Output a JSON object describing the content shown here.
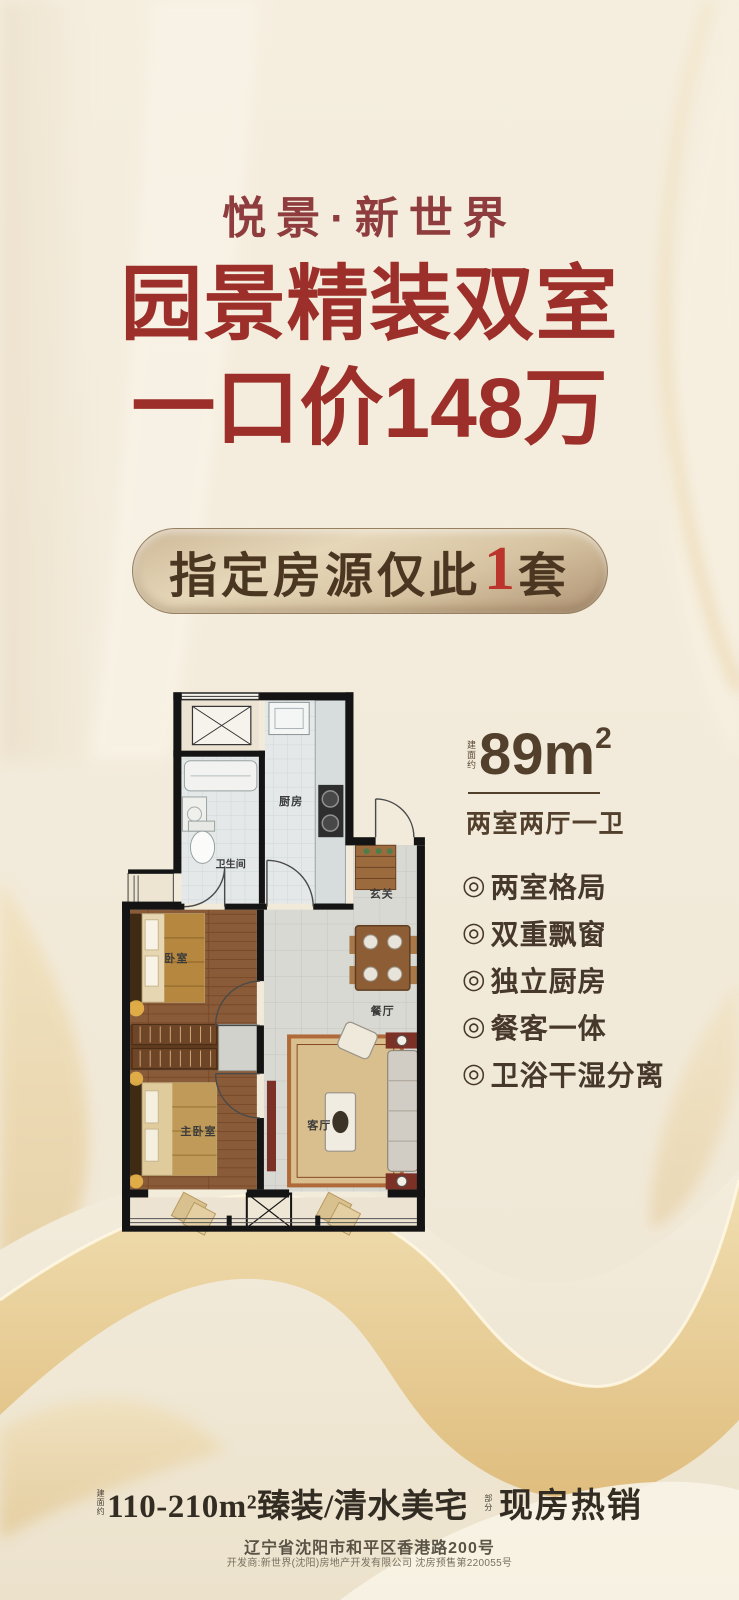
{
  "poster": {
    "brand": "悦景·新世界",
    "headline1": "园景精装双室",
    "headline2": "一口价148万",
    "badge": {
      "prefix": "指定房源仅此",
      "number": "1",
      "suffix": "套"
    },
    "area": {
      "note": "建面约",
      "value": "89m",
      "sup": "2",
      "layout": "两室两厅一卫"
    },
    "feature_bullet": "◎",
    "features": [
      "两室格局",
      "双重飘窗",
      "独立厨房",
      "餐客一体",
      "卫浴干湿分离"
    ],
    "floorplan": {
      "rooms": [
        {
          "name": "厨房"
        },
        {
          "name": "卫生间"
        },
        {
          "name": "玄关"
        },
        {
          "name": "餐厅"
        },
        {
          "name": "客厅"
        },
        {
          "name": "卧室"
        },
        {
          "name": "主卧室"
        }
      ]
    },
    "footer": {
      "note": "建面约",
      "main": "110-210m²臻装/清水美宅",
      "note2": "部分",
      "hot": "现房热销",
      "address": "辽宁省沈阳市和平区香港路200号",
      "developer": "开发商:新世界(沈阳)房地产开发有限公司 沈房预售第220055号"
    },
    "colors": {
      "accent_red": "#9c2f29",
      "brand_maroon": "#8e3c3d",
      "text_brown": "#4a3826",
      "gold": "#e2bf7d"
    }
  }
}
